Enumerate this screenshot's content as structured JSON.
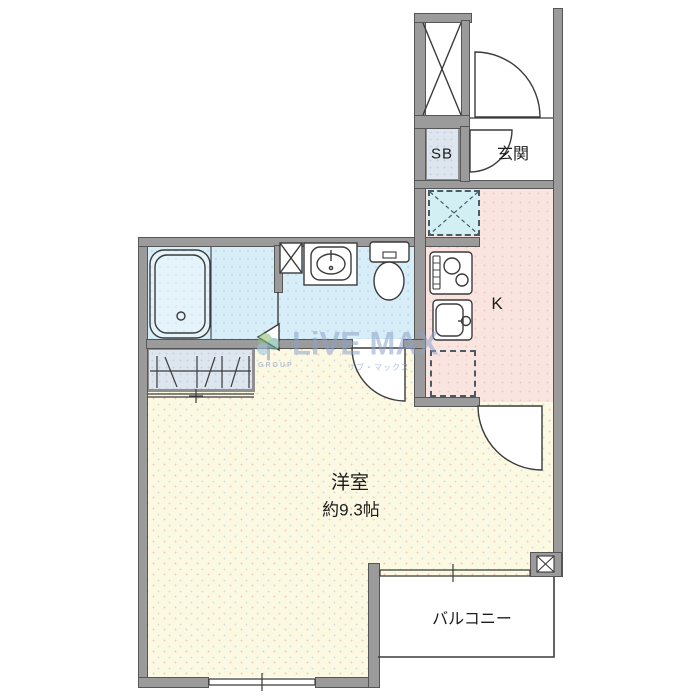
{
  "floorplan": {
    "rooms": {
      "entrance": {
        "label": "玄関"
      },
      "shoe_box": {
        "label": "SB"
      },
      "kitchen": {
        "label": "K"
      },
      "main_room": {
        "label": "洋室",
        "size": "約9.3帖"
      },
      "balcony": {
        "label": "バルコニー"
      }
    },
    "fixtures": [
      "pipe-shaft",
      "bathtub",
      "wash-basin",
      "toilet",
      "washing-machine-space",
      "gas-stove",
      "kitchen-sink",
      "refrigerator-space",
      "closet-hangers",
      "balcony-pipe-shaft"
    ],
    "watermark": {
      "brand": "LiVE MAX",
      "group": "GROUP",
      "company": "リブ・マックス"
    },
    "colors": {
      "wall": "#9b9b9b",
      "bath": "#d7eef8",
      "kitchen": "#f9e4df",
      "main_room": "#fcf9e2",
      "storage": "#dde5ef",
      "washer_space": "#d2eff3",
      "watermark": "#93a9c9"
    }
  }
}
